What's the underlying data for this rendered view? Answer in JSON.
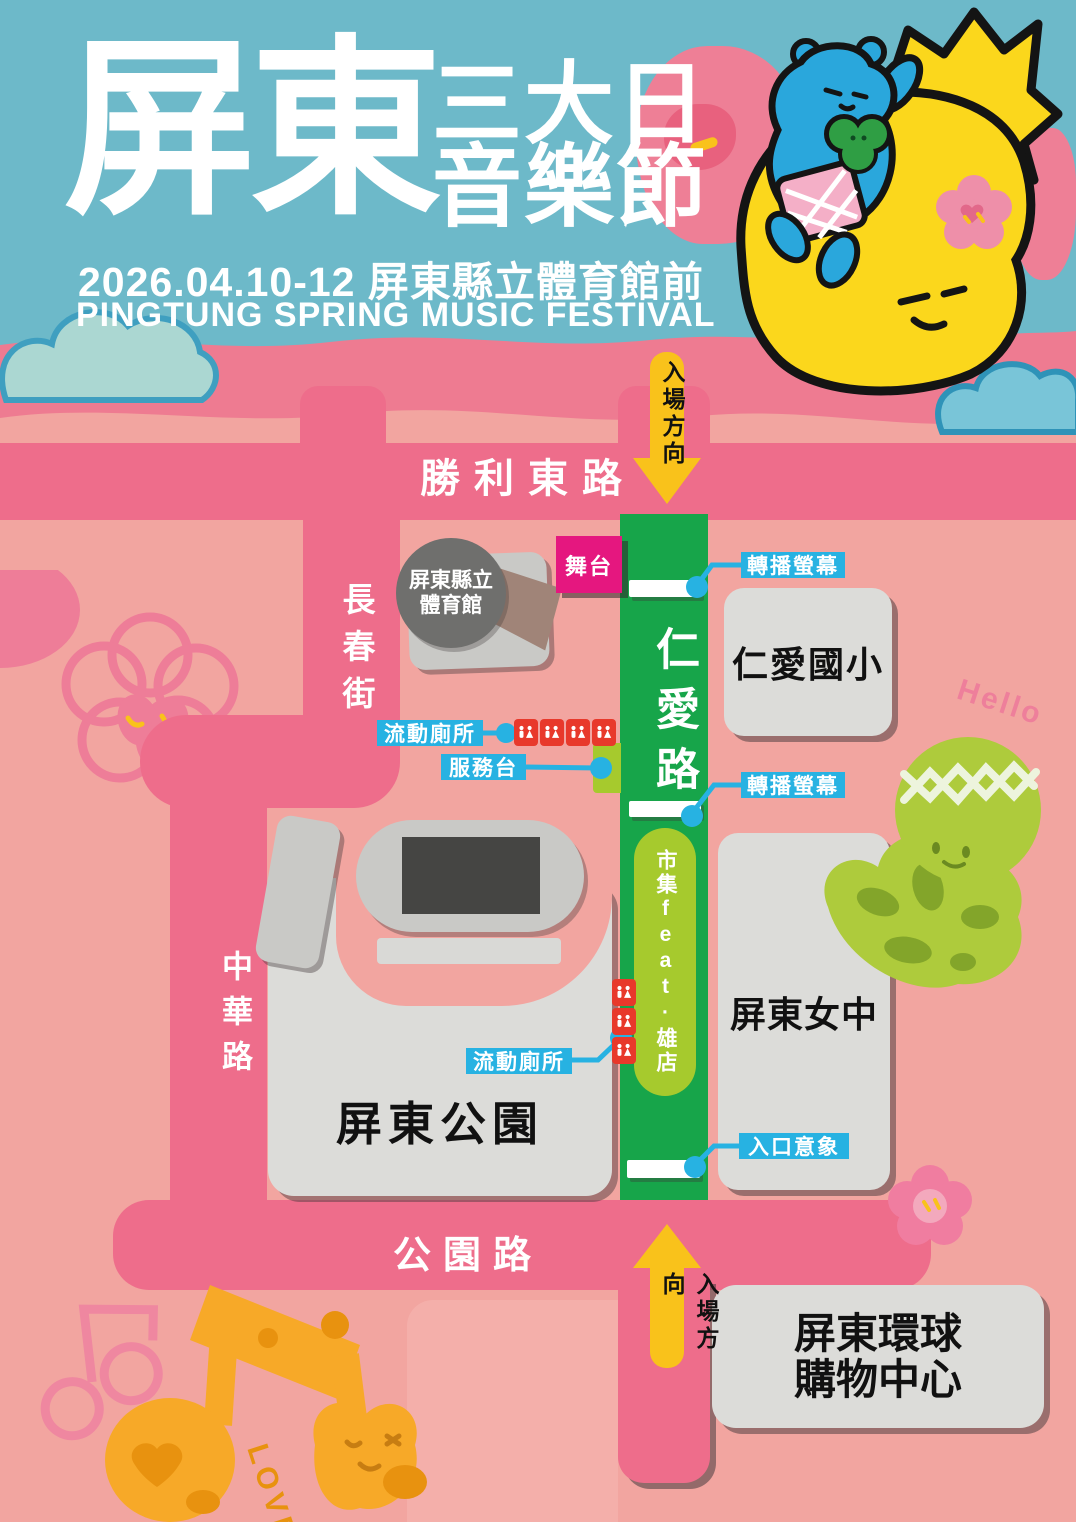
{
  "poster": {
    "title_zh": "屏東",
    "title_sub": [
      "三大日",
      "音樂節"
    ],
    "date_venue": "2026.04.10-12 屏東縣立體育館前",
    "title_en": "PINGTUNG SPRING MUSIC FESTIVAL"
  },
  "roads": {
    "shengli_east": "勝利東路",
    "changchun": "長春街",
    "zhonghua": "中華路",
    "gongyuan": "公園路",
    "renai": "仁愛路"
  },
  "places": {
    "stadium": [
      "屏東縣立",
      "體育館"
    ],
    "renai_elementary": "仁愛國小",
    "pingtung_girls_high": "屏東女中",
    "pingtung_park": "屏東公園",
    "global_mall": [
      "屏東環球",
      "購物中心"
    ]
  },
  "facilities": {
    "stage": "舞台",
    "broadcast_screen": "轉播螢幕",
    "portable_toilet": "流動廁所",
    "service_desk": "服務台",
    "market": "市集feat·雄店",
    "entrance_gate": "入口意象",
    "entry_direction": "入場方向"
  },
  "decor": {
    "hello": "Hello",
    "love": "LOVE"
  },
  "colors": {
    "sky": "#6db9c9",
    "band_pink": "#ee7b91",
    "map_bg": "#f2a5a0",
    "road_pink": "#ee6d8b",
    "road_green": "#17a54a",
    "label_cyan": "#27b2e2",
    "stage_magenta": "#e5177f",
    "toilet_red": "#e8392b",
    "arrow_yellow": "#f9c21b",
    "block_gray": "#dcdcd9",
    "market_green": "#a6ca2d",
    "mascot_yellow": "#fbd71c",
    "bear_blue": "#2aa7dc",
    "note_orange": "#f7a928"
  }
}
